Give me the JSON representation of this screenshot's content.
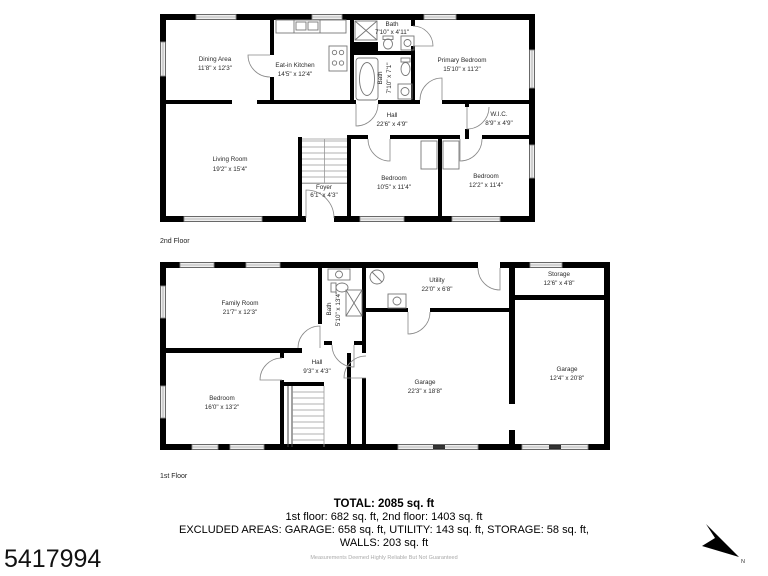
{
  "listing_id": "5417994",
  "compass": {
    "north_label": "N"
  },
  "style": {
    "wall_color": "#000000",
    "window_color": "#8a8a8a",
    "label_color": "#2a2a2a"
  },
  "floor2": {
    "label": "2nd Floor",
    "rooms": {
      "dining": {
        "name": "Dining Area",
        "dims": "11'8\" x 12'3\""
      },
      "kitchen": {
        "name": "Eat-in Kitchen",
        "dims": "14'5\" x 12'4\""
      },
      "bath1": {
        "name": "Bath",
        "dims": "7'10\" x 4'11\""
      },
      "bath2": {
        "name": "Bath",
        "dims": "7'10\" x 7'1\""
      },
      "primary": {
        "name": "Primary Bedroom",
        "dims": "15'10\" x 11'2\""
      },
      "hall": {
        "name": "Hall",
        "dims": "22'6\" x 4'9\""
      },
      "wic": {
        "name": "W.I.C.",
        "dims": "8'9\" x 4'9\""
      },
      "living": {
        "name": "Living Room",
        "dims": "19'2\" x 15'4\""
      },
      "foyer": {
        "name": "Foyer",
        "dims": "6'1\" x 4'3\""
      },
      "bedroom1": {
        "name": "Bedroom",
        "dims": "10'5\" x 11'4\""
      },
      "bedroom2": {
        "name": "Bedroom",
        "dims": "12'2\" x 11'4\""
      }
    }
  },
  "floor1": {
    "label": "1st Floor",
    "rooms": {
      "family": {
        "name": "Family Room",
        "dims": "21'7\" x 12'3\""
      },
      "bath": {
        "name": "Bath",
        "dims": "5'10\" x 13'4\""
      },
      "utility": {
        "name": "Utility",
        "dims": "22'0\" x 6'8\""
      },
      "storage": {
        "name": "Storage",
        "dims": "12'6\" x 4'8\""
      },
      "hall": {
        "name": "Hall",
        "dims": "9'3\" x 4'3\""
      },
      "bedroom": {
        "name": "Bedroom",
        "dims": "16'0\" x 13'2\""
      },
      "garage1": {
        "name": "Garage",
        "dims": "22'3\" x 18'8\""
      },
      "garage2": {
        "name": "Garage",
        "dims": "12'4\" x 20'8\""
      }
    }
  },
  "summary": {
    "total": "TOTAL: 2085 sq. ft",
    "floors_line": "1st floor: 682 sq. ft, 2nd floor: 1403 sq. ft",
    "excluded_line": "EXCLUDED AREAS: GARAGE: 658 sq. ft, UTILITY: 143 sq. ft, STORAGE: 58 sq. ft,",
    "walls_line": "WALLS: 203 sq. ft",
    "disclaimer": "Measurements Deemed Highly Reliable But Not Guaranteed"
  }
}
